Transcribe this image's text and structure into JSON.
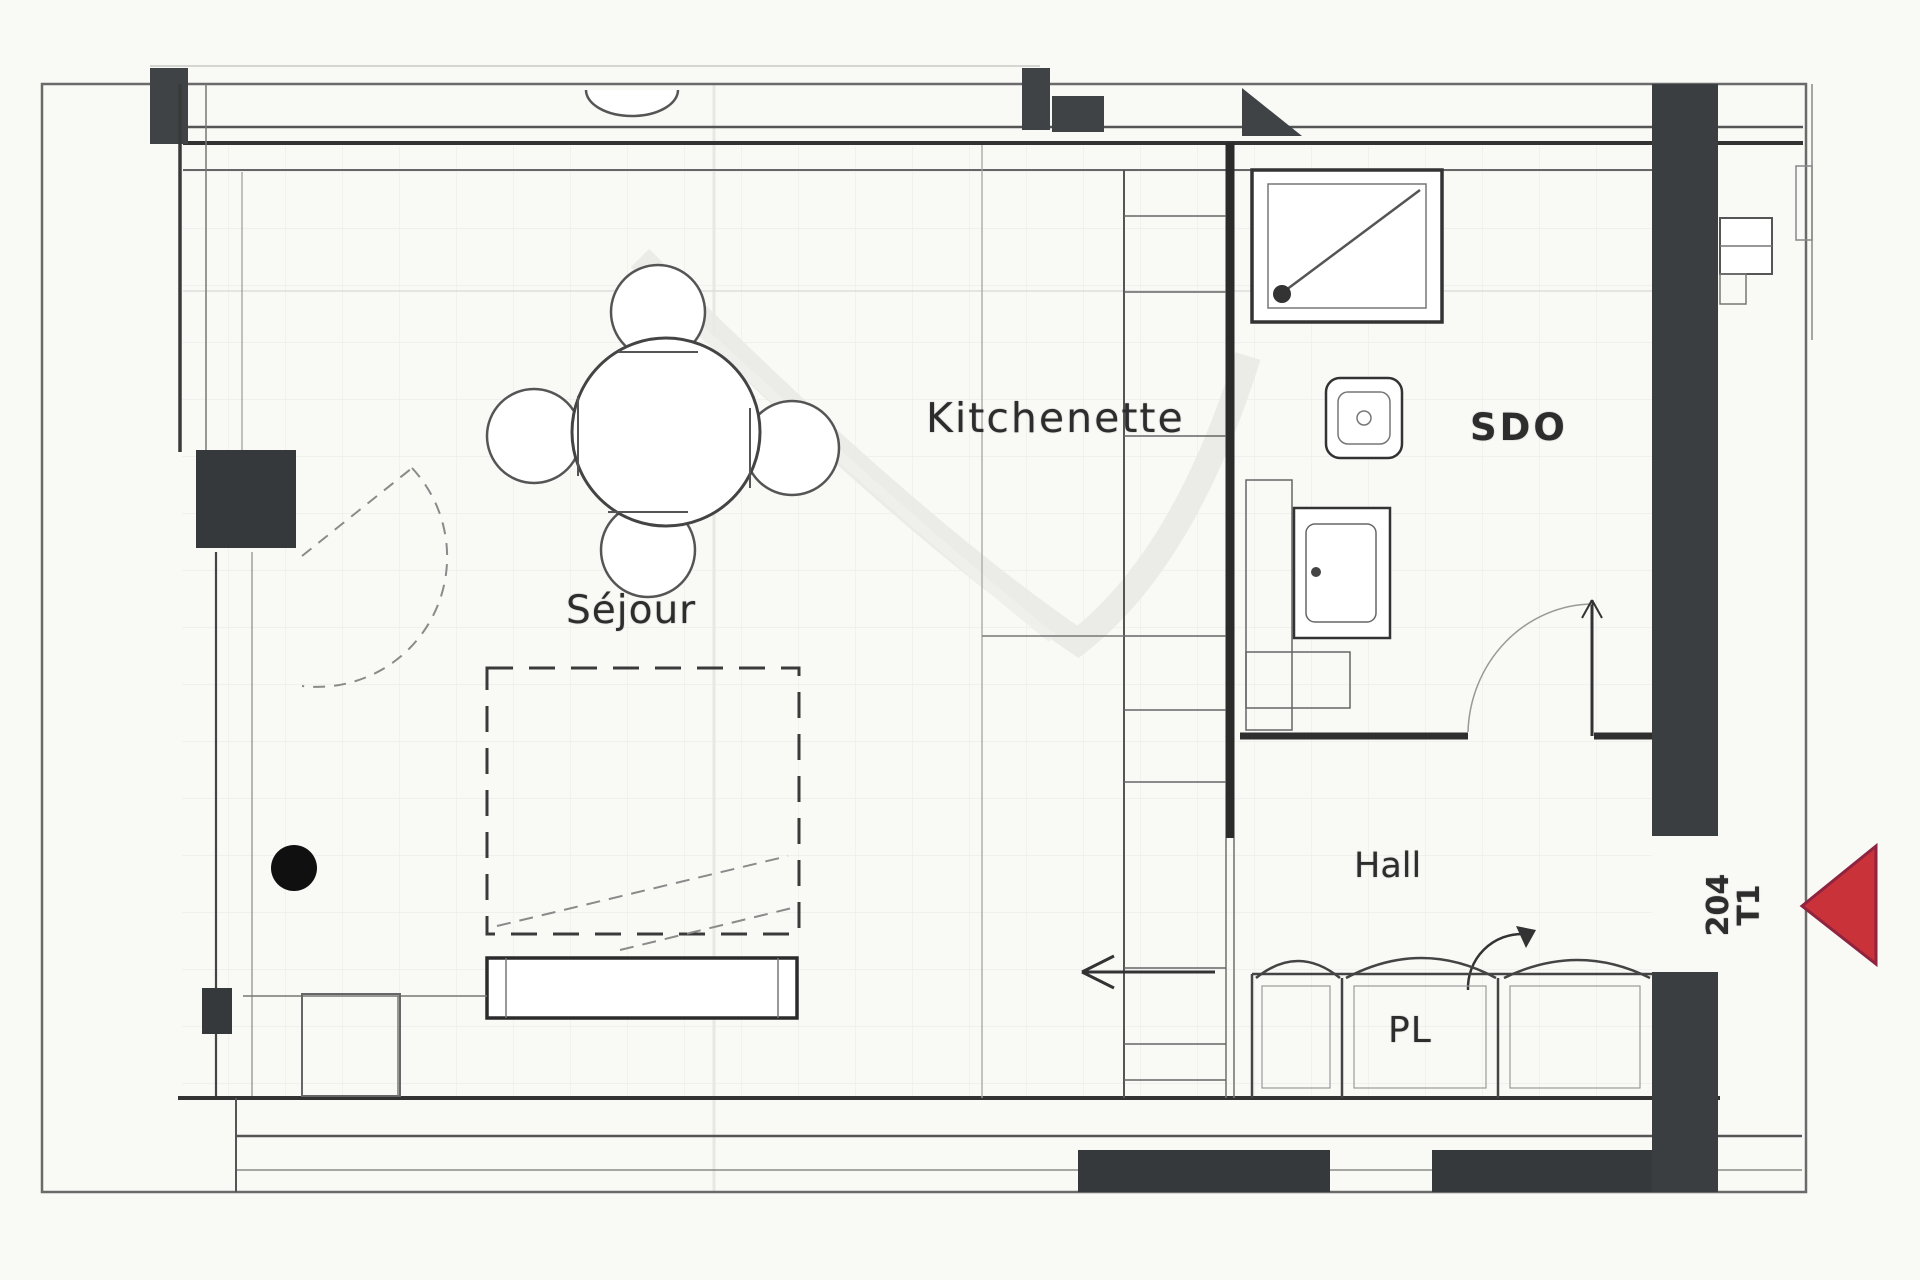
{
  "floorplan": {
    "rooms": [
      {
        "id": "sejour",
        "label": "Séjour"
      },
      {
        "id": "kitchenette",
        "label": "Kitchenette"
      },
      {
        "id": "sdo",
        "label": "SDO"
      },
      {
        "id": "hall",
        "label": "Hall"
      },
      {
        "id": "pl",
        "label": "PL"
      }
    ],
    "unit": {
      "number": "204",
      "type": "T1"
    },
    "marker": {
      "shape": "triangle-pointing-left",
      "color": "#c83238"
    },
    "colors": {
      "wall_line": "#2b2b2b",
      "wall_fill": "#3a3e40",
      "light_line": "#8a8a8a",
      "background": "#f9f9f6",
      "marker_red": "#c83238"
    },
    "fixtures": [
      "dining-table-4-chairs",
      "sofa-bed-dashed-outline",
      "sofa",
      "shower",
      "wc-toilet",
      "washbasin-vanity",
      "sliding-door-wardrobe",
      "entry-direction-arrow",
      "door-swing",
      "structural-column-dot",
      "window-left-wall",
      "window-right-wall"
    ]
  }
}
